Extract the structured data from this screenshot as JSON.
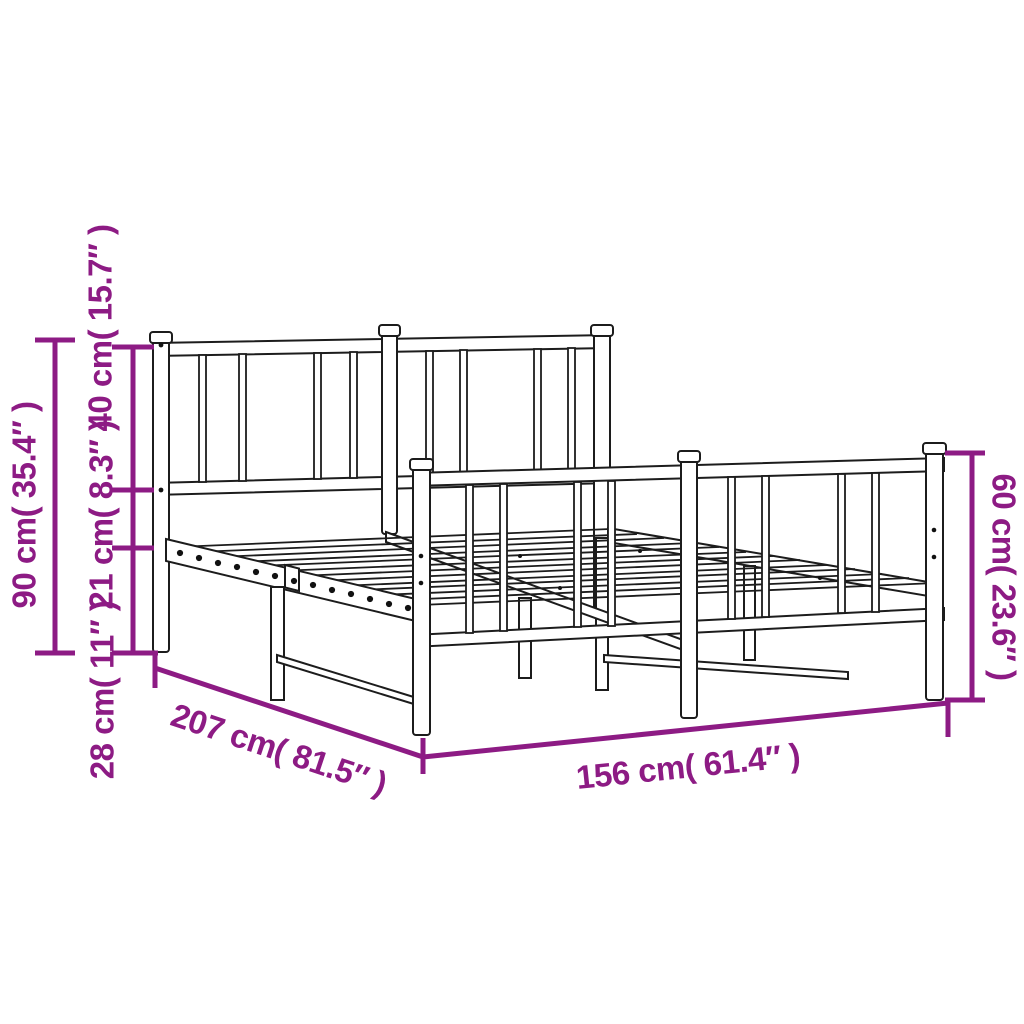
{
  "page": {
    "background": "#ffffff"
  },
  "illustration": {
    "subject": "metal bed frame with headboard and footboard, technical line drawing",
    "outline_color": "#1c1c1c",
    "fill_color": "#ffffff"
  },
  "annotations": {
    "color": "#8D1B84",
    "labels": {
      "headboard_height": "90 cm( 35.4″ )",
      "headboard_top_section": "40 cm( 15.7″ )",
      "frame_side_height": "21 cm( 8.3″ )",
      "under_bed_clearance": "28 cm( 11″ )",
      "bed_length": "207 cm( 81.5″ )",
      "bed_width": "156 cm( 61.4″ )",
      "footboard_height": "60 cm( 23.6″ )"
    },
    "values": {
      "headboard_height": {
        "cm": 90,
        "inch": 35.4
      },
      "headboard_top_section": {
        "cm": 40,
        "inch": 15.7
      },
      "frame_side_height": {
        "cm": 21,
        "inch": 8.3
      },
      "under_bed_clearance": {
        "cm": 28,
        "inch": 11
      },
      "bed_length": {
        "cm": 207,
        "inch": 81.5
      },
      "bed_width": {
        "cm": 156,
        "inch": 61.4
      },
      "footboard_height": {
        "cm": 60,
        "inch": 23.6
      }
    }
  }
}
